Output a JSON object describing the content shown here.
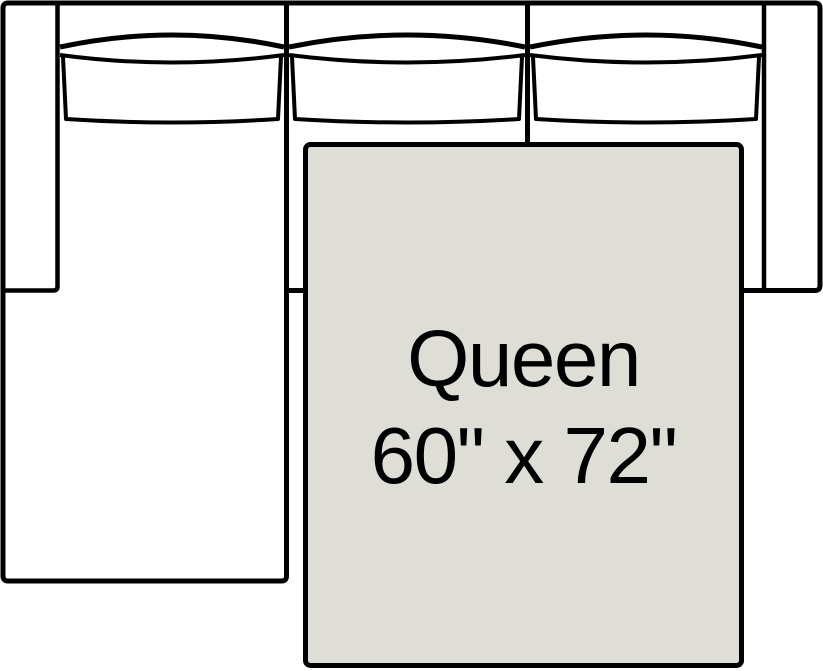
{
  "canvas": {
    "width": 823,
    "height": 671,
    "background_color": "#FFFFFF"
  },
  "sofa": {
    "fill_color": "#FFFFFF",
    "line_color": "#000000",
    "back_cushion_count": 3
  },
  "mattress": {
    "size_label": "Queen",
    "dimensions_label": "60\" x 72\"",
    "width_inches": 60,
    "length_inches": 72,
    "fill_color": "#DEDED6",
    "border_color": "#000000",
    "label_color": "#000000"
  }
}
